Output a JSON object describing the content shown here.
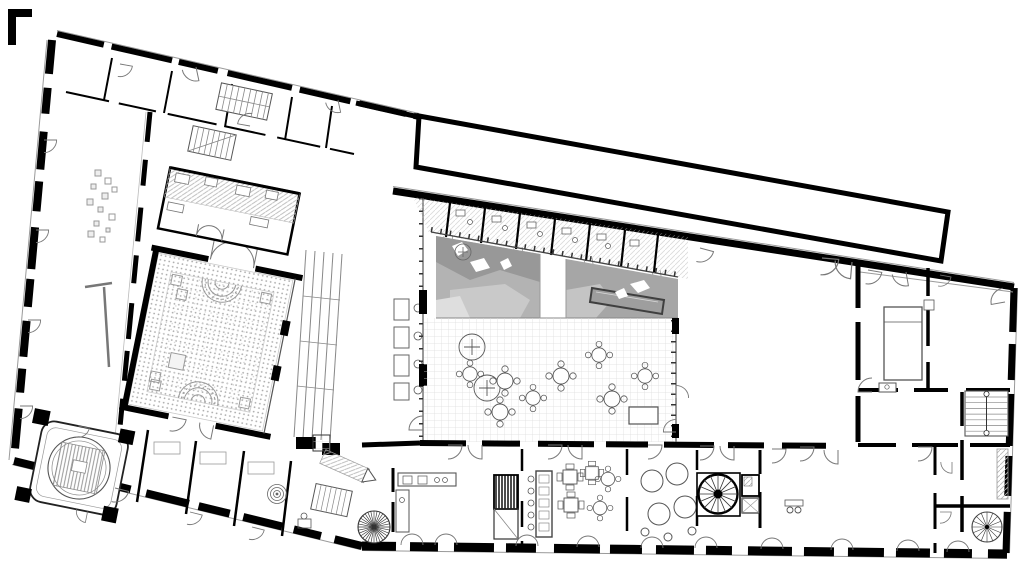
{
  "drawing": {
    "kind": "architectural-floor-plan",
    "style": "black-and-white line drawing, no text labels",
    "visible_text": ""
  },
  "palette": {
    "background": "#ffffff",
    "wall": "#000000",
    "wall_soft": "#333333",
    "furniture": "#555555",
    "light_line": "#9a9a9a",
    "faint_line": "#bbbbbb",
    "tile_line": "#dcdcdc",
    "hatch": "#b5b5b5",
    "dots_fine": "#d2d2d2",
    "dots_dense": "#aaaaaa",
    "stripes": "#8a8a8a",
    "stripes_dark": "#1f1f1f",
    "garden_dark": "#989898",
    "garden_mid": "#b3b3b3",
    "garden_soft": "#c9c9c9",
    "garden_pale": "#dedede",
    "garden_base_east": "#a6a6a6",
    "garden_light_east": "#c4c4c4",
    "pond_fill": "#9e9e9e",
    "pond_edge": "#3f3f3f",
    "boulder": "#ffffff",
    "glazing": "#444444"
  },
  "regions": [
    {
      "id": "west-exhibition-gallery"
    },
    {
      "id": "workshop-room"
    },
    {
      "id": "arcaded-courtyard"
    },
    {
      "id": "courtyard-fountain-north"
    },
    {
      "id": "courtyard-fountain-south"
    },
    {
      "id": "domed-hall"
    },
    {
      "id": "ramp-gallery"
    },
    {
      "id": "reception-lobby"
    },
    {
      "id": "patio-garden-west"
    },
    {
      "id": "patio-garden-east"
    },
    {
      "id": "garden-pond"
    },
    {
      "id": "cafe-terrace"
    },
    {
      "id": "wc-block"
    },
    {
      "id": "gallery-strip"
    },
    {
      "id": "event-hall"
    },
    {
      "id": "east-bedroom"
    },
    {
      "id": "east-stair"
    },
    {
      "id": "store-shelves"
    },
    {
      "id": "spiral-stair-southeast"
    },
    {
      "id": "kitchen"
    },
    {
      "id": "service-shaft"
    },
    {
      "id": "bar-counter"
    },
    {
      "id": "dining-room"
    },
    {
      "id": "lounge-round-tables"
    },
    {
      "id": "spiral-stair-main"
    },
    {
      "id": "elevator"
    },
    {
      "id": "spiral-stair-southwest"
    },
    {
      "id": "south-stair"
    }
  ]
}
